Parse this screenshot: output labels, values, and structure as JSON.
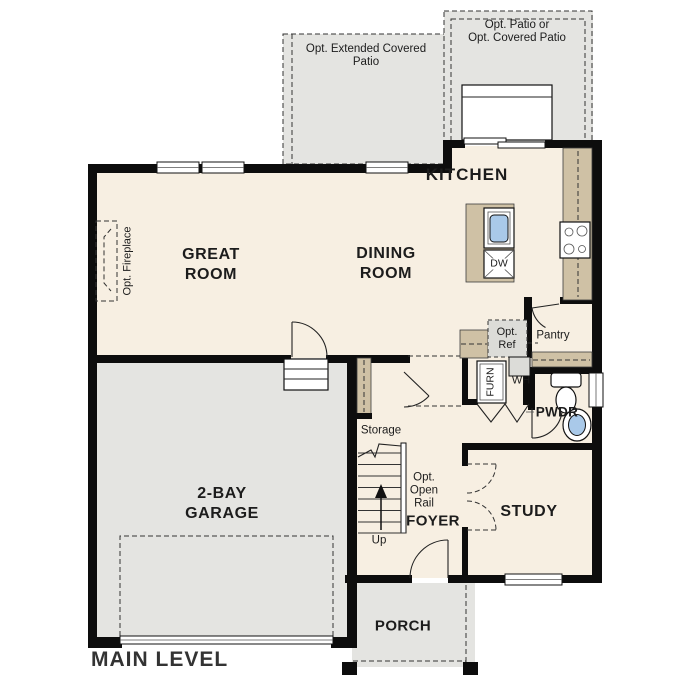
{
  "title": "MAIN LEVEL",
  "colors": {
    "floor": "#f7efe2",
    "outdoor": "#e4e4e1",
    "counter": "#cfc1a5",
    "wall": "#0d0d0d",
    "sink_blue": "#a9c9e9",
    "appliance_gray": "#dcdcd8",
    "title_text": "#333333",
    "label_text": "#1c1c1c"
  },
  "rooms": {
    "great_room": "GREAT\nROOM",
    "dining_room": "DINING\nROOM",
    "kitchen": "KITCHEN",
    "garage": "2-BAY\nGARAGE",
    "study": "STUDY",
    "foyer": "FOYER",
    "porch": "PORCH",
    "powder": "PWDR",
    "pantry": "Pantry",
    "storage": "Storage"
  },
  "annotations": {
    "patio_left": "Opt. Extended Covered\nPatio",
    "patio_right": "Opt. Patio or\nOpt. Covered Patio",
    "fireplace": "Opt. Fireplace",
    "refrigerator": "Opt.\nRef",
    "open_rail": "Opt.\nOpen\nRail",
    "stairs_direction": "Up",
    "water_heater": "WH",
    "furnace": "FURN",
    "dishwasher": "DW"
  }
}
